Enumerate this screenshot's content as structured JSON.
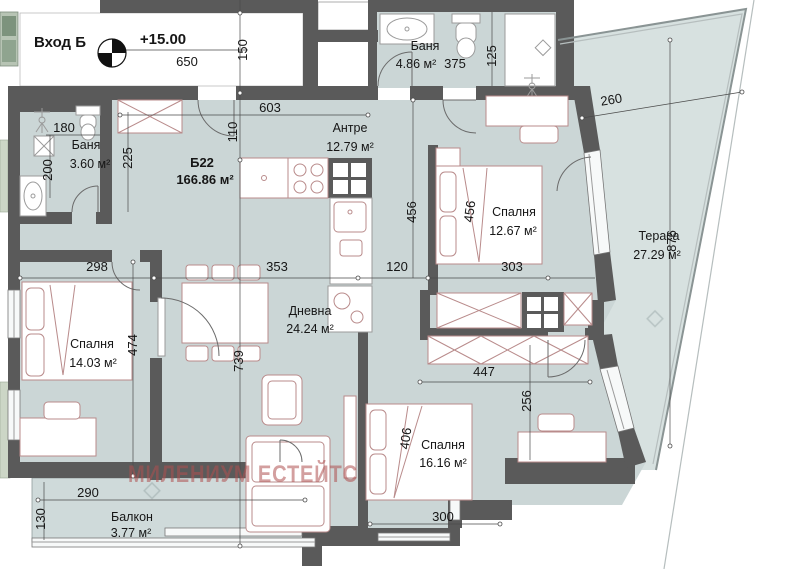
{
  "plan": {
    "entrance_label": "Вход Б",
    "elevation_mark": "+15.00",
    "unit": {
      "id": "Б22",
      "area": "166.86 м²"
    },
    "watermark": "МИЛЕНИУМ ЕСТЕЙТС",
    "rooms": {
      "bath_top": {
        "name": "Баня",
        "area": "4.86 м²"
      },
      "bath_left": {
        "name": "Баня",
        "area": "3.60 м²"
      },
      "antre": {
        "name": "Антре",
        "area": "12.79 м²"
      },
      "bedroom_right": {
        "name": "Спалня",
        "area": "12.67 м²"
      },
      "terrace": {
        "name": "Тераса",
        "area": "27.29 м²"
      },
      "bedroom_left": {
        "name": "Спалня",
        "area": "14.03 м²"
      },
      "living": {
        "name": "Дневна",
        "area": "24.24 м²"
      },
      "bedroom_bottom": {
        "name": "Спалня",
        "area": "16.16 м²"
      },
      "balcony": {
        "name": "Балкон",
        "area": "3.77 м²"
      }
    },
    "dimensions": {
      "d650": "650",
      "d150": "150",
      "d603": "603",
      "d110": "110",
      "d375": "375",
      "d125": "125",
      "d260": "260",
      "d180": "180",
      "d200": "200",
      "d225": "225",
      "d456_hall": "456",
      "d456_bed": "456",
      "d876": "876",
      "d298": "298",
      "d353": "353",
      "d120": "120",
      "d303": "303",
      "d474": "474",
      "d739": "739",
      "d447": "447",
      "d256": "256",
      "d406": "406",
      "d300": "300",
      "d290": "290",
      "d130": "130"
    },
    "colors": {
      "floor": "#cbd6d6",
      "terrace_floor": "#d7e1e0",
      "wall": "#5a5a5a",
      "furniture_line": "#b98b8b",
      "watermark": "#b05050",
      "neighbor_floor": "#b7c4b4"
    }
  }
}
